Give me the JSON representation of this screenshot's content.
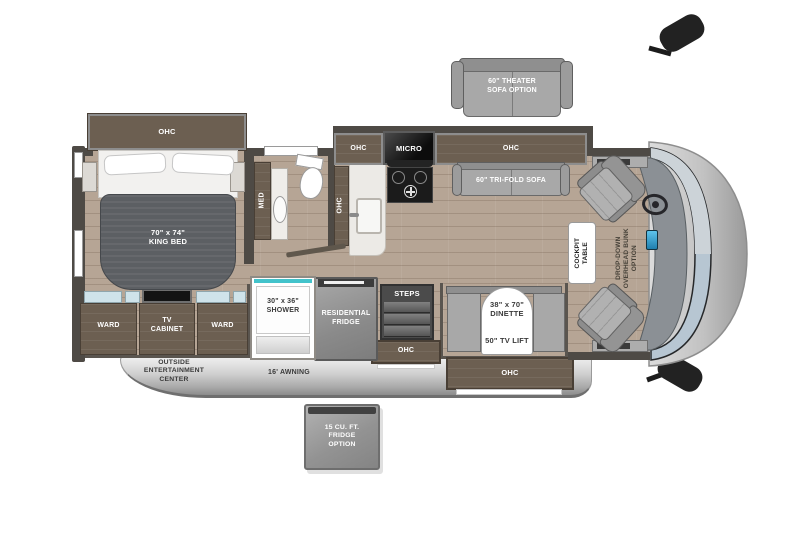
{
  "title": "Class A motorhome floor plan",
  "colors": {
    "floor_wood": "#b6a595",
    "wall": "#4e4a45",
    "cabinet_brown": "#6c5f51",
    "sofa_gray": "#a8a8a8",
    "shower_teal": "#43c3cb",
    "windshield_blue": "#b7c6d2",
    "awning_gray": "#c9c9c9"
  },
  "bedroom": {
    "ohc": "OHC",
    "king_bed": "70\" x 74\"\nKING BED",
    "med": "MED",
    "ward_left": "WARD",
    "tv_cabinet": "TV\nCABINET",
    "ward_right": "WARD"
  },
  "bathroom": {
    "ohc": "OHC"
  },
  "kitchen": {
    "ohc_left": "OHC",
    "micro": "MICRO",
    "ohc_right": "OHC",
    "residential_fridge": "RESIDENTIAL\nFRIDGE",
    "shower": "30\" x 36\"\nSHOWER"
  },
  "living": {
    "tri_fold_sofa": "60\" TRI-FOLD SOFA",
    "dinette": "38\" x 70\"\nDINETTE",
    "tv_lift": "50\" TV LIFT",
    "dinette_ohc": "OHC"
  },
  "entry": {
    "steps": "STEPS",
    "ohc": "OHC"
  },
  "cockpit": {
    "table": "COCKPIT\nTABLE"
  },
  "options": {
    "theater_sofa": "60\" THEATER\nSOFA OPTION",
    "overhead_bunk": "DROP-DOWN\nOVERHEAD BUNK\nOPTION",
    "fridge_option": "15 CU. FT.\nFRIDGE\nOPTION"
  },
  "exterior": {
    "entertainment_center": "OUTSIDE\nENTERTAINMENT\nCENTER",
    "awning": "16' AWNING"
  }
}
